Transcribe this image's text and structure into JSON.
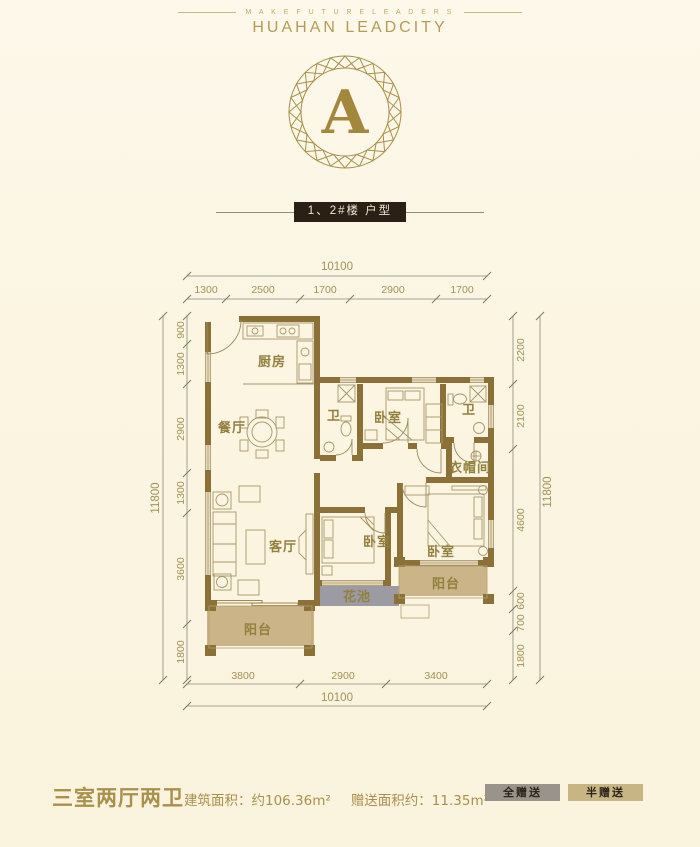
{
  "header": {
    "tagline": "M A K E   F U T U R E   L E A D E R S",
    "brand": "HUAHAN LEADCITY"
  },
  "emblem": {
    "letter": "A"
  },
  "section_label": "1、2#楼 户型",
  "rooms": {
    "kitchen": "厨房",
    "dining": "餐厅",
    "living": "客厅",
    "bedroom": "卧室",
    "bath": "卫",
    "cloakroom": "衣帽间",
    "balcony": "阳台",
    "flower_bed": "花池"
  },
  "dimensions": {
    "top": {
      "total": "10100",
      "segments": [
        "1300",
        "2500",
        "1700",
        "2900",
        "1700"
      ]
    },
    "bottom": {
      "total": "10100",
      "segments": [
        "3800",
        "2900",
        "3400"
      ]
    },
    "left": {
      "total": "11800",
      "segments": [
        "900",
        "1300",
        "2900",
        "1300",
        "3600",
        "1800"
      ]
    },
    "right": {
      "total": "11800",
      "segments": [
        "2200",
        "2100",
        "4600",
        "600",
        "700",
        "1800"
      ]
    }
  },
  "footer": {
    "layout_type": "三室两厅两卫",
    "built_area": "建筑面积：约106.36m²",
    "gift_area": "赠送面积约：11.35m²",
    "badges": [
      {
        "label": "全赠送"
      },
      {
        "label": "半赠送"
      }
    ]
  },
  "colors": {
    "background": "#fbf5e2",
    "brand_gold": "#b59c55",
    "wall_brown": "#8b7137",
    "label_bar_bg": "#2a2016",
    "balcony_fill": "#cab488",
    "flower_bed_fill": "#9c9ba4",
    "badge_full_bg": "#98938b",
    "badge_half_bg": "#c7b584",
    "footer_gold": "#a8904d"
  }
}
